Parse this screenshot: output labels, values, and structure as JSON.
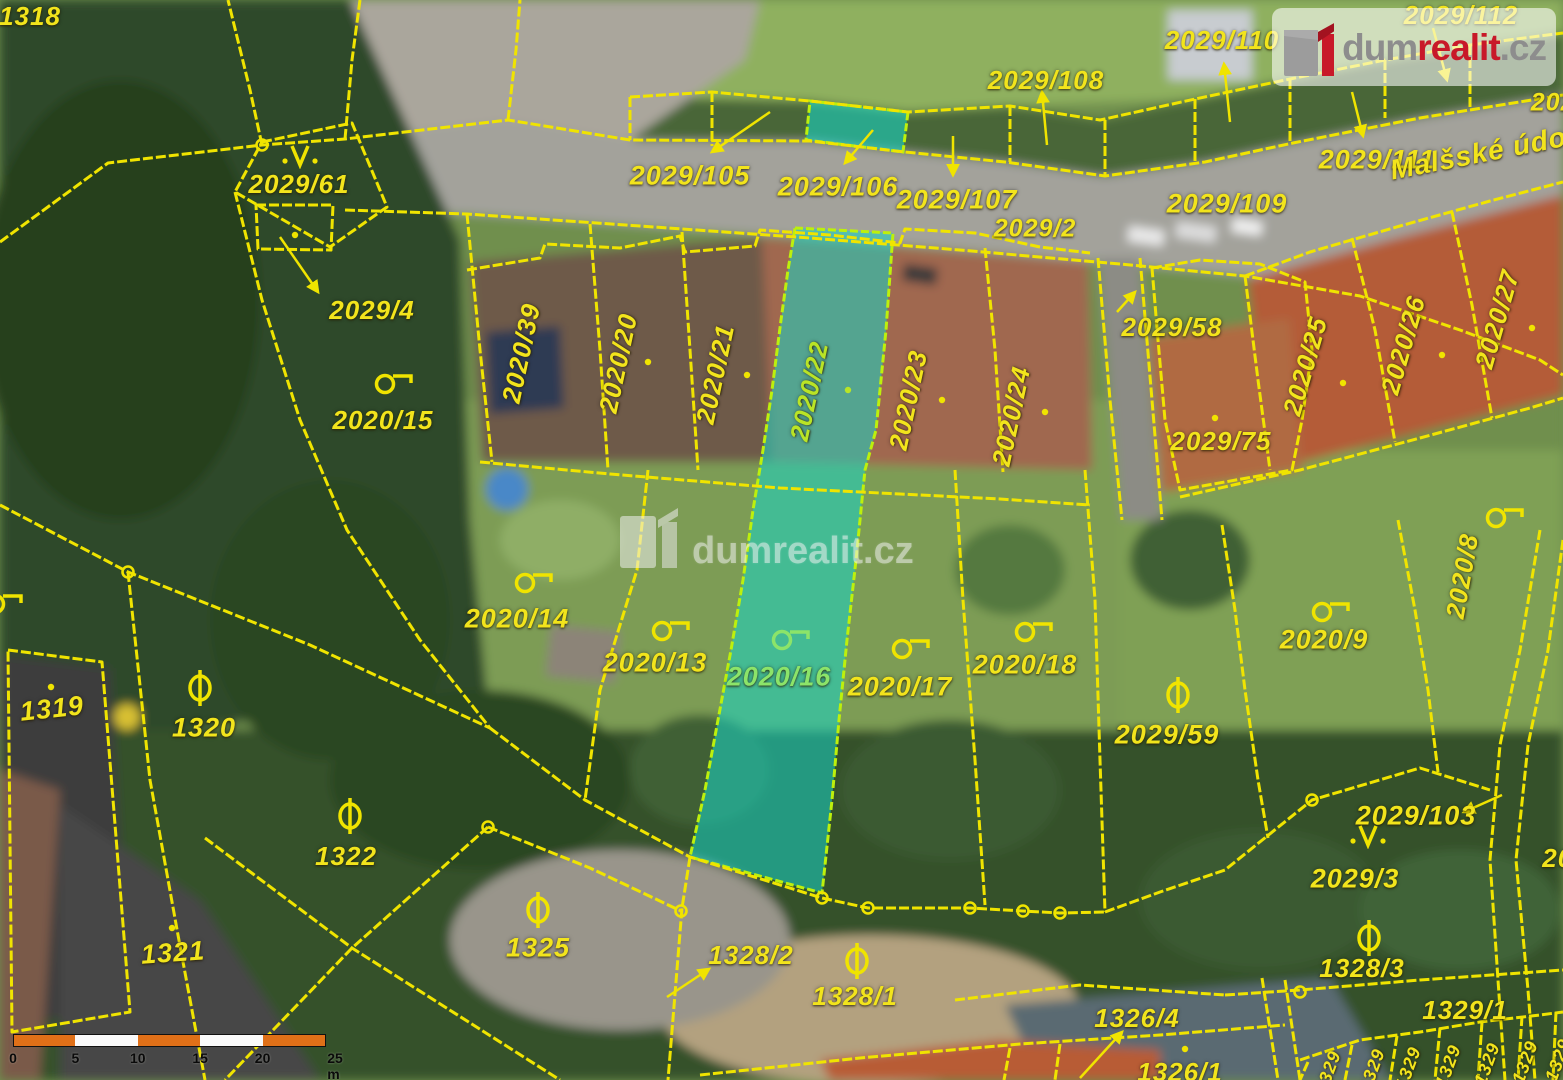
{
  "branding": {
    "logo_dum": "dum",
    "logo_realit": "realit",
    "logo_tld": ".cz",
    "watermark_text": "dumrealit.cz"
  },
  "street": {
    "name": "Malšské údolí"
  },
  "highlight": {
    "fill": "#16d6c6",
    "edge": "#d6f50a"
  },
  "line_color": "#f0e400",
  "label_color": "#f2e41c",
  "scale_bar": {
    "unit_labels": [
      "0",
      "5",
      "10",
      "15",
      "20",
      "25 m"
    ],
    "segment_colors": [
      "#e07018",
      "#fafafa"
    ]
  },
  "labels": [
    {
      "text": "1318",
      "x": 30,
      "y": 16,
      "rot": 0,
      "size": 26
    },
    {
      "text": "2029/112",
      "x": 1461,
      "y": 15,
      "rot": 0,
      "size": 26
    },
    {
      "text": "2029/110",
      "x": 1222,
      "y": 40,
      "rot": 0,
      "size": 26
    },
    {
      "text": "2029/108",
      "x": 1046,
      "y": 80,
      "rot": 0,
      "size": 26
    },
    {
      "text": "2029/1",
      "x": 1572,
      "y": 103,
      "rot": 0,
      "size": 25
    },
    {
      "text": "2029/105",
      "x": 690,
      "y": 176,
      "rot": 0,
      "size": 27
    },
    {
      "text": "2029/106",
      "x": 838,
      "y": 187,
      "rot": 0,
      "size": 27
    },
    {
      "text": "2029/107",
      "x": 957,
      "y": 200,
      "rot": 0,
      "size": 27
    },
    {
      "text": "2029/111",
      "x": 1377,
      "y": 160,
      "rot": 0,
      "size": 27
    },
    {
      "text": "Malšské údolí",
      "x": 1487,
      "y": 152,
      "rot": -11,
      "size": 28,
      "kind": "street"
    },
    {
      "text": "2029/109",
      "x": 1227,
      "y": 204,
      "rot": 0,
      "size": 27
    },
    {
      "text": "2029/2",
      "x": 1035,
      "y": 229,
      "rot": 0,
      "size": 25
    },
    {
      "text": "2029/61",
      "x": 299,
      "y": 184,
      "rot": 0,
      "size": 26
    },
    {
      "text": "2029/4",
      "x": 372,
      "y": 310,
      "rot": 0,
      "size": 26
    },
    {
      "text": "2020/15",
      "x": 383,
      "y": 420,
      "rot": 0,
      "size": 26
    },
    {
      "text": "2029/58",
      "x": 1172,
      "y": 327,
      "rot": 0,
      "size": 26
    },
    {
      "text": "2029/75",
      "x": 1221,
      "y": 441,
      "rot": 0,
      "size": 26
    },
    {
      "text": "2020/39",
      "x": 521,
      "y": 353,
      "rot": -78,
      "size": 26
    },
    {
      "text": "2020/20",
      "x": 618,
      "y": 363,
      "rot": -78,
      "size": 26
    },
    {
      "text": "2020/21",
      "x": 715,
      "y": 374,
      "rot": -78,
      "size": 26
    },
    {
      "text": "2020/22",
      "x": 809,
      "y": 391,
      "rot": -78,
      "size": 26,
      "color": "#b9e426"
    },
    {
      "text": "2020/23",
      "x": 908,
      "y": 400,
      "rot": -78,
      "size": 26
    },
    {
      "text": "2020/24",
      "x": 1011,
      "y": 416,
      "rot": -78,
      "size": 26
    },
    {
      "text": "2020/25",
      "x": 1305,
      "y": 366,
      "rot": -74,
      "size": 26
    },
    {
      "text": "2020/26",
      "x": 1403,
      "y": 345,
      "rot": -74,
      "size": 26
    },
    {
      "text": "2020/27",
      "x": 1497,
      "y": 319,
      "rot": -74,
      "size": 26
    },
    {
      "text": "2020/8",
      "x": 1462,
      "y": 576,
      "rot": -80,
      "size": 26
    },
    {
      "text": "2020/14",
      "x": 517,
      "y": 619,
      "rot": 0,
      "size": 27
    },
    {
      "text": "2020/13",
      "x": 655,
      "y": 663,
      "rot": 0,
      "size": 27
    },
    {
      "text": "2020/16",
      "x": 779,
      "y": 677,
      "rot": 0,
      "size": 27,
      "color": "#8ce469"
    },
    {
      "text": "2020/17",
      "x": 900,
      "y": 687,
      "rot": 0,
      "size": 27
    },
    {
      "text": "2020/18",
      "x": 1025,
      "y": 665,
      "rot": 0,
      "size": 27
    },
    {
      "text": "2020/9",
      "x": 1324,
      "y": 640,
      "rot": 0,
      "size": 27
    },
    {
      "text": "2029/59",
      "x": 1167,
      "y": 735,
      "rot": 0,
      "size": 27
    },
    {
      "text": "2029/103",
      "x": 1416,
      "y": 816,
      "rot": 0,
      "size": 27
    },
    {
      "text": "2029/3",
      "x": 1355,
      "y": 879,
      "rot": 0,
      "size": 27
    },
    {
      "text": "2029/2",
      "x": 1585,
      "y": 858,
      "rot": 0,
      "size": 26
    },
    {
      "text": "1319",
      "x": 52,
      "y": 709,
      "rot": -6,
      "size": 27
    },
    {
      "text": "1320",
      "x": 204,
      "y": 728,
      "rot": 0,
      "size": 27
    },
    {
      "text": "1322",
      "x": 346,
      "y": 856,
      "rot": 0,
      "size": 26
    },
    {
      "text": "1321",
      "x": 173,
      "y": 953,
      "rot": -4,
      "size": 27
    },
    {
      "text": "1325",
      "x": 538,
      "y": 948,
      "rot": 0,
      "size": 27
    },
    {
      "text": "1328/2",
      "x": 751,
      "y": 955,
      "rot": 0,
      "size": 26
    },
    {
      "text": "1328/1",
      "x": 855,
      "y": 996,
      "rot": 0,
      "size": 26
    },
    {
      "text": "1328/3",
      "x": 1362,
      "y": 968,
      "rot": 0,
      "size": 26
    },
    {
      "text": "1329/1",
      "x": 1465,
      "y": 1010,
      "rot": 0,
      "size": 26
    },
    {
      "text": "1326/4",
      "x": 1137,
      "y": 1018,
      "rot": 0,
      "size": 26
    },
    {
      "text": "1326/1",
      "x": 1180,
      "y": 1072,
      "rot": 0,
      "size": 26
    },
    {
      "text": "1329",
      "x": 1328,
      "y": 1072,
      "rot": -70,
      "size": 18
    },
    {
      "text": "1329",
      "x": 1372,
      "y": 1070,
      "rot": -70,
      "size": 18
    },
    {
      "text": "1329",
      "x": 1408,
      "y": 1068,
      "rot": -70,
      "size": 18
    },
    {
      "text": "1329",
      "x": 1448,
      "y": 1066,
      "rot": -70,
      "size": 18
    },
    {
      "text": "1329",
      "x": 1487,
      "y": 1064,
      "rot": -70,
      "size": 18
    },
    {
      "text": "1329",
      "x": 1525,
      "y": 1062,
      "rot": -70,
      "size": 18
    },
    {
      "text": "1329",
      "x": 1558,
      "y": 1060,
      "rot": -70,
      "size": 18
    }
  ],
  "symbols": [
    {
      "kind": "vee",
      "x": 300,
      "y": 156
    },
    {
      "kind": "vee",
      "x": 1368,
      "y": 836
    },
    {
      "kind": "theta",
      "x": 200,
      "y": 688
    },
    {
      "kind": "theta",
      "x": 350,
      "y": 816
    },
    {
      "kind": "theta",
      "x": 538,
      "y": 910
    },
    {
      "kind": "theta",
      "x": 857,
      "y": 961
    },
    {
      "kind": "theta",
      "x": 1369,
      "y": 938
    },
    {
      "kind": "theta",
      "x": 1178,
      "y": 695
    },
    {
      "kind": "ring",
      "x": 394,
      "y": 382
    },
    {
      "kind": "ring",
      "x": 534,
      "y": 581
    },
    {
      "kind": "ring",
      "x": 671,
      "y": 629
    },
    {
      "kind": "ring",
      "x": 791,
      "y": 638,
      "color": "#8ce469"
    },
    {
      "kind": "ring",
      "x": 911,
      "y": 647
    },
    {
      "kind": "ring",
      "x": 1034,
      "y": 630
    },
    {
      "kind": "ring",
      "x": 1331,
      "y": 610
    },
    {
      "kind": "ring",
      "x": 1505,
      "y": 516
    },
    {
      "kind": "ring",
      "x": 4,
      "y": 602
    },
    {
      "kind": "dot",
      "x": 295,
      "y": 230
    },
    {
      "kind": "dot",
      "x": 51,
      "y": 682
    },
    {
      "kind": "dot",
      "x": 172,
      "y": 923
    },
    {
      "kind": "dot",
      "x": 648,
      "y": 357
    },
    {
      "kind": "dot",
      "x": 747,
      "y": 370
    },
    {
      "kind": "dot",
      "x": 848,
      "y": 385,
      "color": "#b9e426"
    },
    {
      "kind": "dot",
      "x": 942,
      "y": 395
    },
    {
      "kind": "dot",
      "x": 1045,
      "y": 407
    },
    {
      "kind": "dot",
      "x": 1343,
      "y": 378
    },
    {
      "kind": "dot",
      "x": 1442,
      "y": 350
    },
    {
      "kind": "dot",
      "x": 1532,
      "y": 323
    },
    {
      "kind": "dot",
      "x": 1215,
      "y": 413
    },
    {
      "kind": "dot",
      "x": 1185,
      "y": 1044
    },
    {
      "kind": "vertex",
      "x": 262,
      "y": 145
    },
    {
      "kind": "vertex",
      "x": 128,
      "y": 572
    },
    {
      "kind": "vertex",
      "x": 488,
      "y": 827
    },
    {
      "kind": "vertex",
      "x": 681,
      "y": 911
    },
    {
      "kind": "vertex",
      "x": 822,
      "y": 898
    },
    {
      "kind": "vertex",
      "x": 868,
      "y": 908
    },
    {
      "kind": "vertex",
      "x": 970,
      "y": 908
    },
    {
      "kind": "vertex",
      "x": 1023,
      "y": 911
    },
    {
      "kind": "vertex",
      "x": 1060,
      "y": 913
    },
    {
      "kind": "vertex",
      "x": 1312,
      "y": 800
    },
    {
      "kind": "vertex",
      "x": 1300,
      "y": 992
    }
  ]
}
